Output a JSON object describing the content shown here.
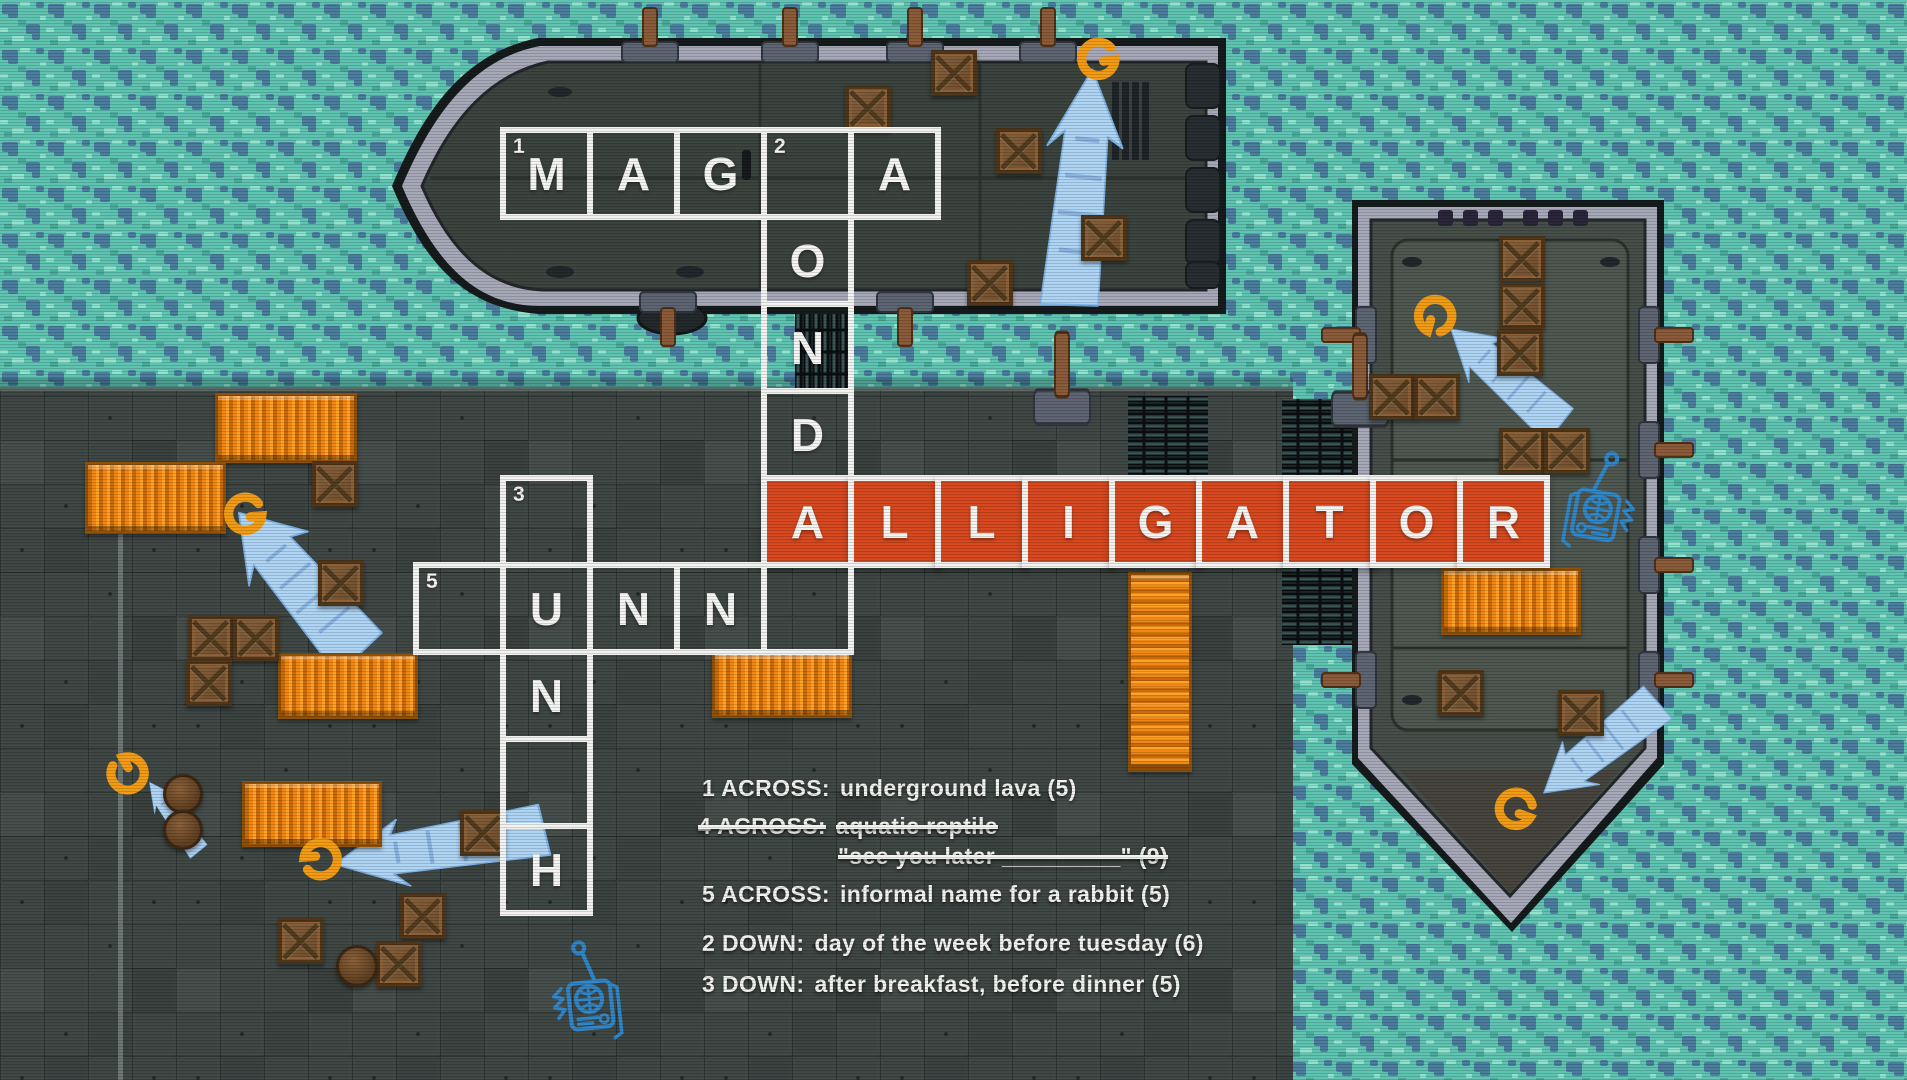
{
  "crossword": {
    "origin": {
      "x": 416,
      "y": 130
    },
    "cell_px": 87,
    "solved_fill": "#d7481e",
    "border_color": "#f2f2f0",
    "letter_color": "#f4f4f2",
    "words": {
      "across_1": "MAGMA",
      "across_4": "ALLIGATOR",
      "across_5": "BUNNY",
      "down_2": "MONDAY",
      "down_3": "LUNCH"
    },
    "cells": [
      {
        "c": 1,
        "r": 0,
        "ch": "M",
        "n": "1"
      },
      {
        "c": 2,
        "r": 0,
        "ch": "A"
      },
      {
        "c": 3,
        "r": 0,
        "ch": "G"
      },
      {
        "c": 4,
        "r": 0,
        "ch": "",
        "n": "2"
      },
      {
        "c": 5,
        "r": 0,
        "ch": "A"
      },
      {
        "c": 4,
        "r": 1,
        "ch": "O"
      },
      {
        "c": 4,
        "r": 2,
        "ch": "N"
      },
      {
        "c": 4,
        "r": 3,
        "ch": "D"
      },
      {
        "c": 1,
        "r": 4,
        "ch": "",
        "n": "3"
      },
      {
        "c": 4,
        "r": 4,
        "ch": "A",
        "solved": true
      },
      {
        "c": 5,
        "r": 4,
        "ch": "L",
        "solved": true
      },
      {
        "c": 6,
        "r": 4,
        "ch": "L",
        "solved": true
      },
      {
        "c": 7,
        "r": 4,
        "ch": "I",
        "solved": true
      },
      {
        "c": 8,
        "r": 4,
        "ch": "G",
        "solved": true
      },
      {
        "c": 9,
        "r": 4,
        "ch": "A",
        "solved": true
      },
      {
        "c": 10,
        "r": 4,
        "ch": "T",
        "solved": true
      },
      {
        "c": 11,
        "r": 4,
        "ch": "O",
        "solved": true
      },
      {
        "c": 12,
        "r": 4,
        "ch": "R",
        "solved": true
      },
      {
        "c": 0,
        "r": 5,
        "ch": "",
        "n": "5"
      },
      {
        "c": 1,
        "r": 5,
        "ch": "U"
      },
      {
        "c": 2,
        "r": 5,
        "ch": "N"
      },
      {
        "c": 3,
        "r": 5,
        "ch": "N"
      },
      {
        "c": 4,
        "r": 5,
        "ch": ""
      },
      {
        "c": 1,
        "r": 6,
        "ch": "N"
      },
      {
        "c": 1,
        "r": 7,
        "ch": ""
      },
      {
        "c": 1,
        "r": 8,
        "ch": "H"
      }
    ]
  },
  "clues": [
    {
      "label": "1 ACROSS:",
      "text": "underground lava (5)",
      "struck": false,
      "x": 702,
      "y": 775
    },
    {
      "label": "4 ACROSS:",
      "text": "aquatic reptile",
      "struck": true,
      "x": 698,
      "y": 813
    },
    {
      "label": "",
      "text": "\"see you later _________\" (9)",
      "struck": true,
      "x": 838,
      "y": 843
    },
    {
      "label": "5 ACROSS:",
      "text": "informal name for a rabbit (5)",
      "struck": false,
      "x": 702,
      "y": 881
    },
    {
      "label": "2 DOWN:",
      "text": "day of the week before tuesday (6)",
      "struck": false,
      "x": 702,
      "y": 930
    },
    {
      "label": "3 DOWN:",
      "text": "after breakfast, before dinner (5)",
      "struck": false,
      "x": 702,
      "y": 971
    }
  ],
  "props": {
    "containers": [
      {
        "x": 215,
        "y": 393,
        "w": 142,
        "h": 70,
        "dir": "h"
      },
      {
        "x": 85,
        "y": 462,
        "w": 141,
        "h": 72,
        "dir": "h"
      },
      {
        "x": 278,
        "y": 653,
        "w": 140,
        "h": 66,
        "dir": "h"
      },
      {
        "x": 242,
        "y": 781,
        "w": 140,
        "h": 66,
        "dir": "h"
      },
      {
        "x": 712,
        "y": 652,
        "w": 140,
        "h": 66,
        "dir": "h"
      },
      {
        "x": 1441,
        "y": 568,
        "w": 140,
        "h": 67,
        "dir": "h"
      },
      {
        "x": 1128,
        "y": 572,
        "w": 64,
        "h": 200,
        "dir": "v"
      }
    ],
    "crates": [
      {
        "x": 845,
        "y": 85
      },
      {
        "x": 931,
        "y": 50
      },
      {
        "x": 996,
        "y": 128
      },
      {
        "x": 1081,
        "y": 215
      },
      {
        "x": 967,
        "y": 260
      },
      {
        "x": 1499,
        "y": 236
      },
      {
        "x": 1499,
        "y": 283
      },
      {
        "x": 1497,
        "y": 330
      },
      {
        "x": 1369,
        "y": 374
      },
      {
        "x": 1414,
        "y": 374
      },
      {
        "x": 1499,
        "y": 428
      },
      {
        "x": 1544,
        "y": 428
      },
      {
        "x": 1438,
        "y": 670
      },
      {
        "x": 1558,
        "y": 690
      },
      {
        "x": 312,
        "y": 461
      },
      {
        "x": 318,
        "y": 560
      },
      {
        "x": 188,
        "y": 615
      },
      {
        "x": 233,
        "y": 615
      },
      {
        "x": 186,
        "y": 660
      },
      {
        "x": 400,
        "y": 893
      },
      {
        "x": 376,
        "y": 941
      },
      {
        "x": 278,
        "y": 918
      },
      {
        "x": 460,
        "y": 810
      }
    ],
    "barrels": [
      {
        "x": 163,
        "y": 774,
        "s": 40
      },
      {
        "x": 163,
        "y": 810,
        "s": 40
      },
      {
        "x": 336,
        "y": 945,
        "s": 42
      }
    ]
  },
  "icons": {
    "arrows": [
      {
        "x": 1092,
        "y": 72,
        "rot": 6,
        "sx": 0.8,
        "sy": 1.17
      },
      {
        "x": 240,
        "y": 514,
        "rot": -40,
        "sx": 0.85,
        "sy": 0.92
      },
      {
        "x": 337,
        "y": 864,
        "rot": -99,
        "sx": 0.72,
        "sy": 1.05
      },
      {
        "x": 150,
        "y": 783,
        "rot": -35,
        "sx": 0.3,
        "sy": 0.42
      },
      {
        "x": 1452,
        "y": 330,
        "rot": -48,
        "sx": 0.6,
        "sy": 0.72
      },
      {
        "x": 1545,
        "y": 792,
        "rot": -128,
        "sx": 0.6,
        "sy": 0.72
      }
    ],
    "g_marks": [
      {
        "x": 1098,
        "y": 58,
        "rot": -15
      },
      {
        "x": 1436,
        "y": 316,
        "rot": 100
      },
      {
        "x": 1516,
        "y": 808,
        "rot": 15
      },
      {
        "x": 245,
        "y": 513,
        "rot": -10
      },
      {
        "x": 127,
        "y": 774,
        "rot": -125
      },
      {
        "x": 321,
        "y": 860,
        "rot": 170
      }
    ],
    "radios": [
      {
        "x": 1597,
        "y": 508,
        "rot": 10,
        "flip": -1
      },
      {
        "x": 590,
        "y": 998,
        "rot": -6,
        "flip": 1
      }
    ]
  },
  "colors": {
    "water": "#5ec3b1",
    "water_dark": "#4a7c9e",
    "water_light": "#8fe3cf",
    "dock": "#3e4644",
    "top_boat_deck": "#3a423d",
    "right_boat_deck": "#454d48",
    "hull_band": "#a6a8b8",
    "solved_cell": "#d7481e",
    "container": "#f08712",
    "spray_blue": "#aed4f4",
    "spray_orange": "#f29b13",
    "radio_blue": "#2e86c9"
  }
}
